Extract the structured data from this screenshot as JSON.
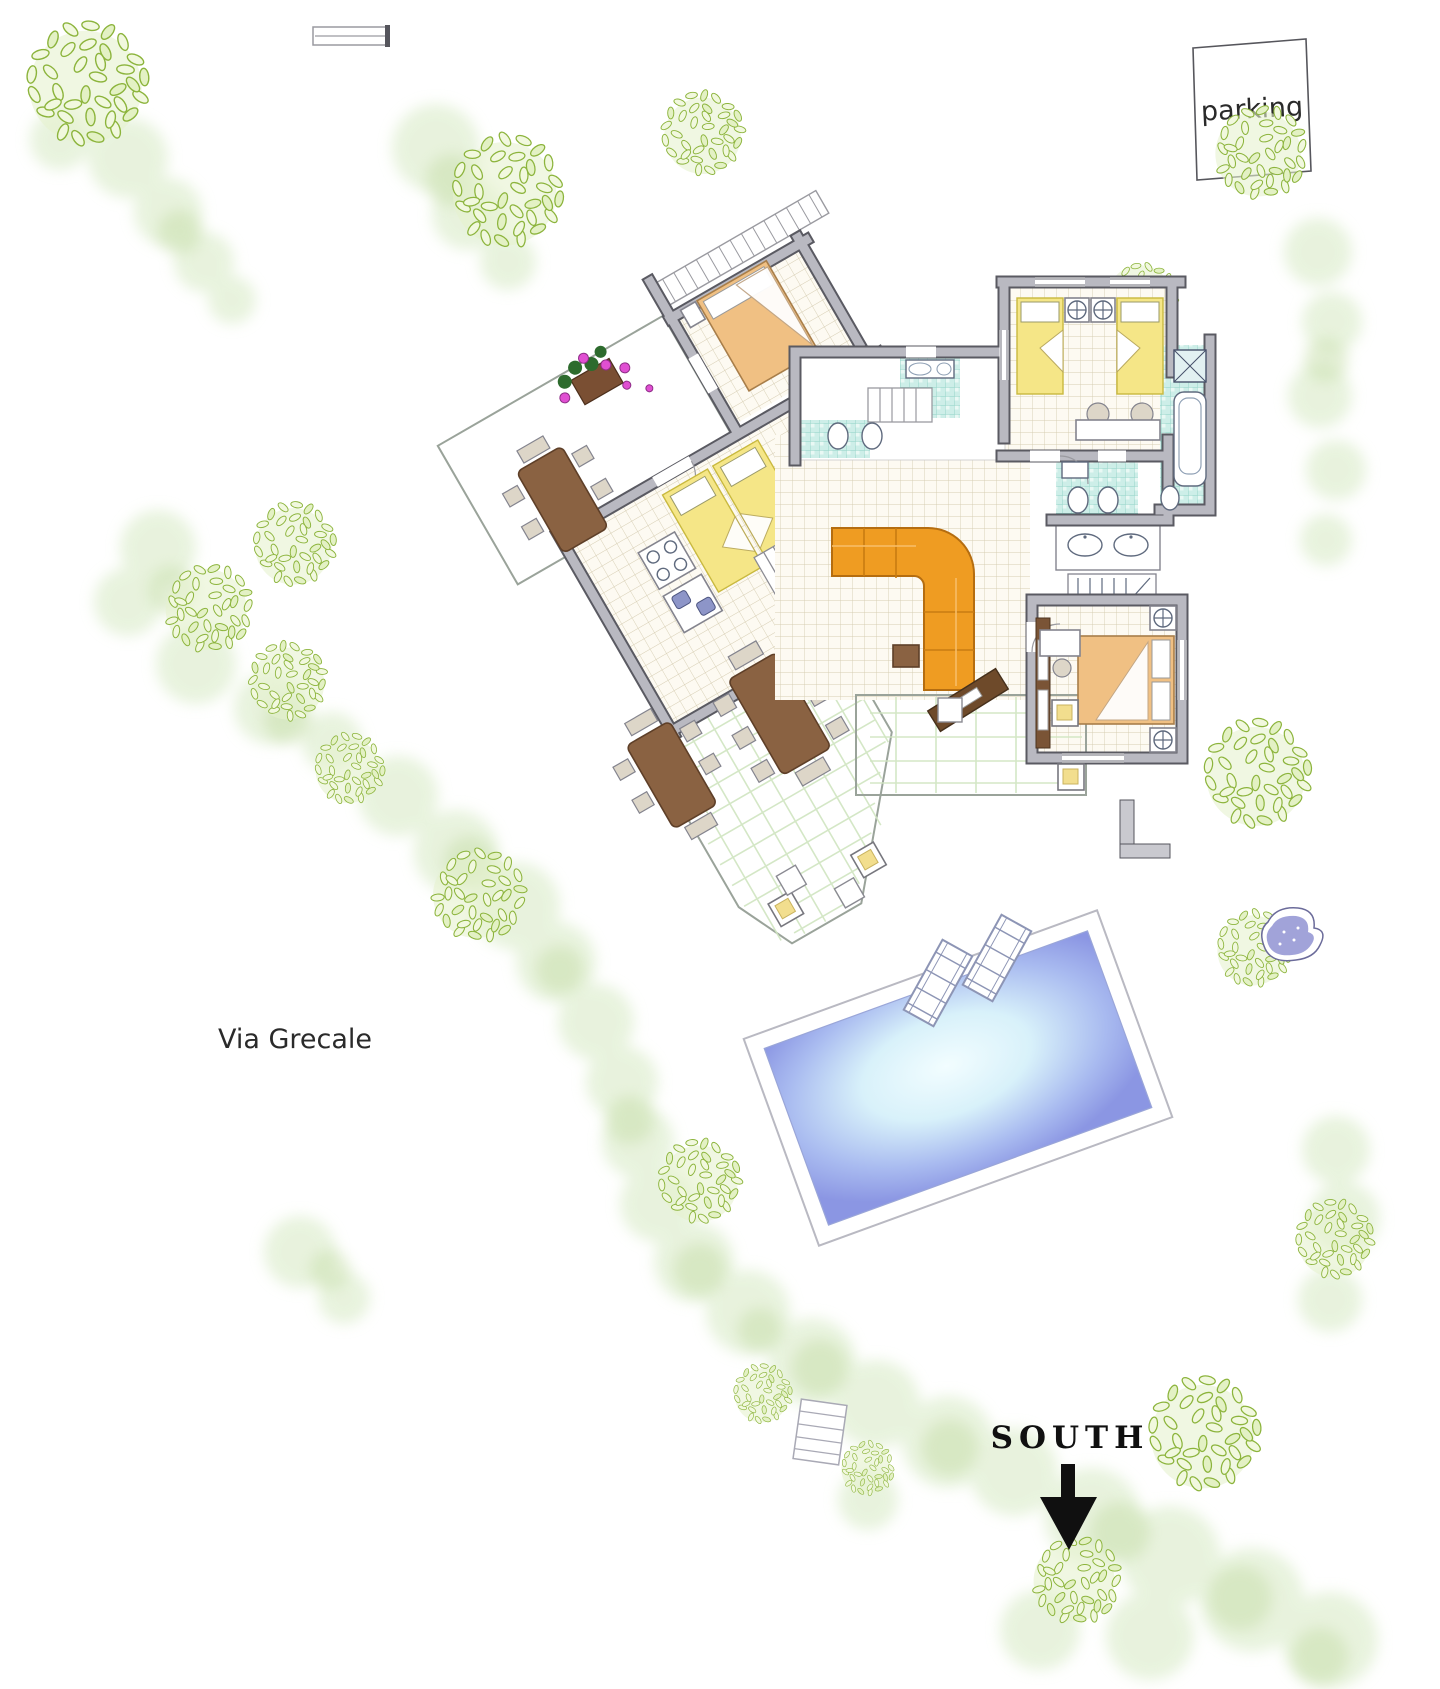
{
  "page": {
    "kind": "villa-site-plan",
    "width": 1440,
    "height": 1689,
    "background": "#ffffff"
  },
  "labels": {
    "parking": "parking",
    "street": "Via Grecale",
    "compass_direction": "SOUTH"
  },
  "palette": {
    "wall": "#b9b9c1",
    "wall_outline": "#5a5a62",
    "tile_floor": "#fdfaf2",
    "tile_grid": "#d6cdb2",
    "bath_tile": "#cdeee8",
    "bath_grid": "#8fd2c6",
    "terrace": "#e6f4de",
    "terrace_grid": "#c9e3bd",
    "hedge_soft": "#d9ebc8",
    "hedge_dark": "#c3dca4",
    "tree_leaf_stroke": "#8cb43c",
    "tree_leaf_fill": "#f1f8de",
    "pool_deep": "#8b96e3",
    "pool_shallow": "#f2fdff",
    "sofa": "#ef9c22",
    "bed_double": "#f0c083",
    "bed_single": "#f5e687",
    "wood": "#8a6242",
    "flower": "#e04fd2",
    "label_ink": "#222222"
  }
}
